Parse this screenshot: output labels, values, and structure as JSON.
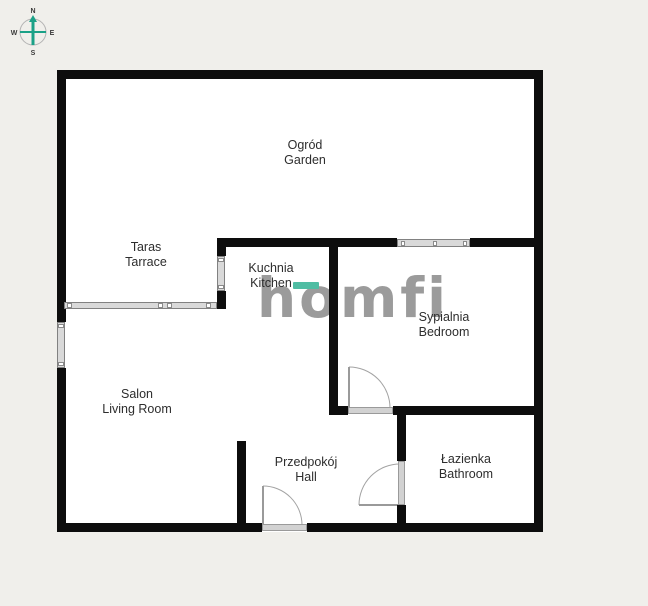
{
  "colors": {
    "background": "#f0efeb",
    "wall": "#0d0d0d",
    "floor": "#ffffff",
    "window_fill": "#d9d9d9",
    "accent_teal": "#4fbda3",
    "logo_gray": "#9b9b9b"
  },
  "compass": {
    "north": "N",
    "east": "E",
    "south": "S",
    "west": "W"
  },
  "watermark": {
    "brand": "homfi"
  },
  "rooms": {
    "garden": {
      "pl": "Ogród",
      "en": "Garden"
    },
    "terrace": {
      "pl": "Taras",
      "en": "Tarrace"
    },
    "kitchen": {
      "pl": "Kuchnia",
      "en": "Kitchen"
    },
    "bedroom": {
      "pl": "Sypialnia",
      "en": "Bedroom"
    },
    "living_room": {
      "pl": "Salon",
      "en": "Living Room"
    },
    "hall": {
      "pl": "Przedpokój",
      "en": "Hall"
    },
    "bathroom": {
      "pl": "Łazienka",
      "en": "Bathroom"
    }
  }
}
